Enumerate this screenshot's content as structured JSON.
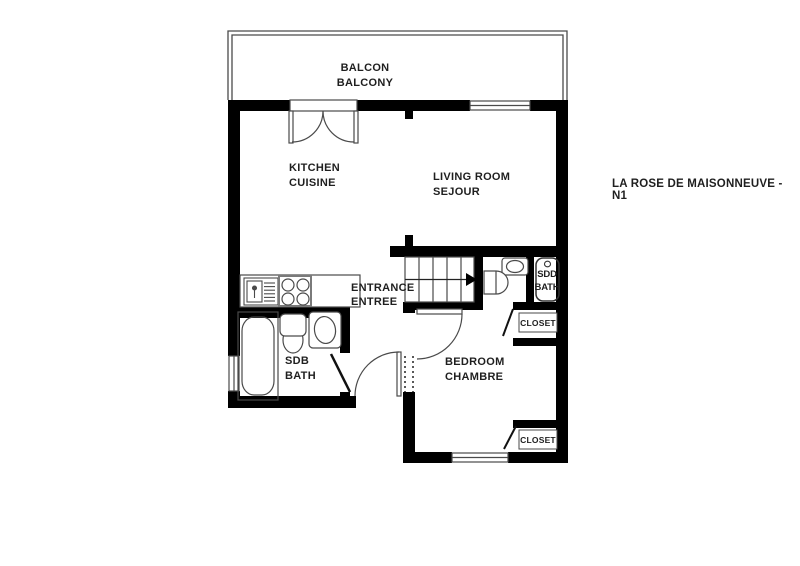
{
  "title": {
    "text": "LA ROSE DE MAISONNEUVE - N1"
  },
  "colors": {
    "wall": "#000000",
    "line": "#4a4a4a",
    "text": "#1f1f1f",
    "background": "#ffffff"
  },
  "rooms": {
    "balcony": {
      "line1": "BALCON",
      "line2": "BALCONY"
    },
    "kitchen": {
      "line1": "KITCHEN",
      "line2": "CUISINE"
    },
    "living_room": {
      "line1": "LIVING ROOM",
      "line2": "SEJOUR"
    },
    "entrance": {
      "line1": "ENTRANCE",
      "line2": "ENTREE"
    },
    "bathroom": {
      "line1": "SDB",
      "line2": "BATH"
    },
    "shower_room": {
      "line1": "SDD",
      "line2": "BATH"
    },
    "bedroom": {
      "line1": "BEDROOM",
      "line2": "CHAMBRE"
    },
    "closet_top": {
      "line1": "CLOSET"
    },
    "closet_bottom": {
      "line1": "CLOSET"
    }
  },
  "fixtures": [
    "kitchen-sink",
    "cooktop",
    "bathtub",
    "toilet",
    "washbasin",
    "shower-tray",
    "stairs",
    "french-door",
    "window",
    "balcony-railing"
  ]
}
